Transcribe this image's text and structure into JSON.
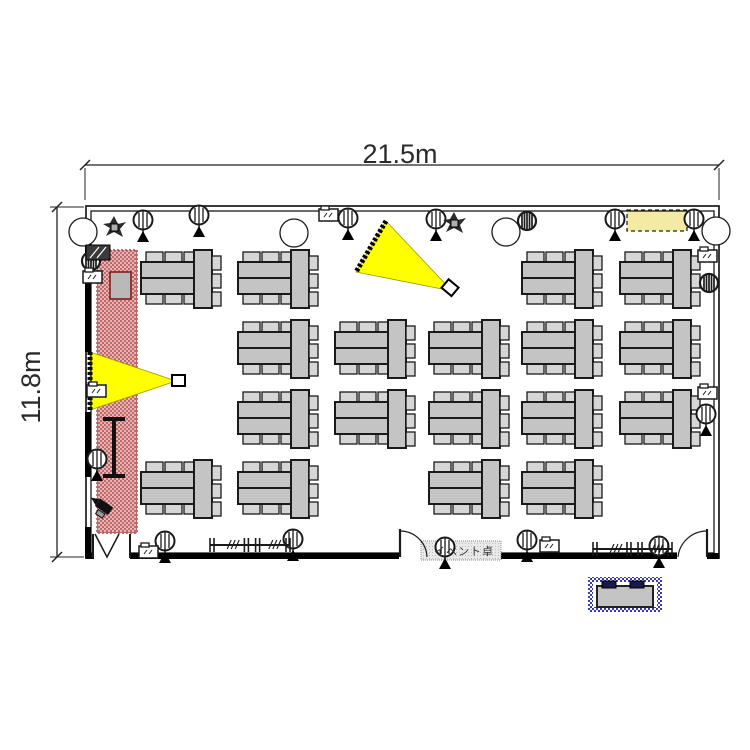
{
  "title": "seminar-room-floor-plan",
  "dimension_labels": {
    "width": "21.5m",
    "height": "11.8m"
  },
  "annotations": {
    "event_desk_label": "イベント卓"
  },
  "colors": {
    "line": "#1a1a1a",
    "table_fill": "#c4c4c4",
    "chair_fill": "#d6d6d6",
    "beam_yellow": "#ffff00",
    "highlight_yellow": "#f3eba3",
    "stage_red_dark": "#c06868",
    "stage_red_light": "#e7b5b5",
    "reception_blue": "#3a3ab0",
    "label_box_fill": "#e4e4e4"
  },
  "plan": {
    "room": {
      "outer": [
        86,
        206,
        633,
        352
      ],
      "inner": [
        91,
        211,
        623,
        342
      ],
      "bottom_door_gaps": [
        [
          93,
          130
        ],
        [
          399,
          428
        ],
        [
          677,
          707
        ]
      ],
      "thick_wall_segments": [
        [
          85,
          245,
          6,
          107
        ],
        [
          85,
          412,
          6,
          65
        ],
        [
          85,
          527,
          6,
          31
        ],
        [
          130,
          553,
          269,
          6
        ],
        [
          428,
          553,
          249,
          6
        ],
        [
          86,
          553,
          8,
          6
        ],
        [
          707,
          553,
          12,
          6
        ]
      ]
    },
    "dim_top": {
      "y": 165,
      "x1": 85,
      "x2": 719,
      "label_x": 400,
      "label_y": 163
    },
    "dim_left": {
      "x": 57,
      "y1": 207,
      "y2": 557,
      "label_x": 40,
      "label_y": 387
    },
    "zones": {
      "stage_area": [
        97,
        250,
        40,
        283
      ],
      "stage_block": [
        110,
        272,
        21,
        27
      ],
      "highlight_top_right": [
        627,
        210,
        60,
        21
      ],
      "label_box": [
        421,
        541,
        80,
        19
      ],
      "reception": [
        588,
        577,
        74,
        35
      ]
    },
    "projector_cones": [
      {
        "pts": "90,352 90,410 176,381",
        "edge": [
          90,
          352,
          90,
          410
        ],
        "box": [
          172,
          375
        ],
        "box_rot": 0
      },
      {
        "pts": "386,221 356,272 452,291",
        "edge": [
          386,
          221,
          356,
          272
        ],
        "box": [
          444,
          282
        ],
        "box_rot": 40
      }
    ],
    "screen_board": {
      "x": 114,
      "y1": 419,
      "y2": 476,
      "cap": 11
    },
    "tables": [
      [
        138,
        248
      ],
      [
        235,
        248
      ],
      [
        519,
        248
      ],
      [
        617,
        248
      ],
      [
        235,
        318
      ],
      [
        332,
        318
      ],
      [
        426,
        318
      ],
      [
        519,
        318
      ],
      [
        617,
        318
      ],
      [
        235,
        388
      ],
      [
        332,
        388
      ],
      [
        426,
        388
      ],
      [
        519,
        388
      ],
      [
        617,
        388
      ],
      [
        138,
        458
      ],
      [
        235,
        458
      ],
      [
        426,
        458
      ],
      [
        519,
        458
      ]
    ],
    "columns": [
      [
        83,
        232
      ],
      [
        294,
        233
      ],
      [
        506,
        232
      ],
      [
        716,
        231
      ]
    ],
    "tripod_lights": [
      [
        143,
        220
      ],
      [
        199,
        215
      ],
      [
        348,
        218
      ],
      [
        436,
        219
      ],
      [
        615,
        219
      ],
      [
        694,
        219
      ],
      [
        97,
        459
      ],
      [
        706,
        414
      ],
      [
        165,
        541
      ],
      [
        293,
        539
      ],
      [
        445,
        547
      ],
      [
        527,
        540
      ],
      [
        659,
        546
      ]
    ],
    "wall_lights": [
      [
        527,
        221
      ],
      [
        709,
        283
      ],
      [
        91,
        261
      ]
    ],
    "equipment_boxes": [
      [
        319,
        209
      ],
      [
        83,
        271
      ],
      [
        698,
        250
      ],
      [
        698,
        387
      ],
      [
        540,
        540
      ],
      [
        139,
        546
      ],
      [
        87,
        385
      ]
    ],
    "speaker_boxes": [
      [
        86,
        245
      ]
    ],
    "plants": [
      [
        114,
        227
      ],
      [
        454,
        223
      ]
    ],
    "cameras": [
      [
        108,
        515
      ]
    ],
    "barriers": [
      [
        210,
        536,
        80
      ],
      [
        593,
        540,
        79
      ]
    ],
    "doors": [
      {
        "type": "fold",
        "x": 95
      },
      {
        "type": "arc_right",
        "x": 400
      },
      {
        "type": "arc_left",
        "x": 707
      }
    ]
  }
}
